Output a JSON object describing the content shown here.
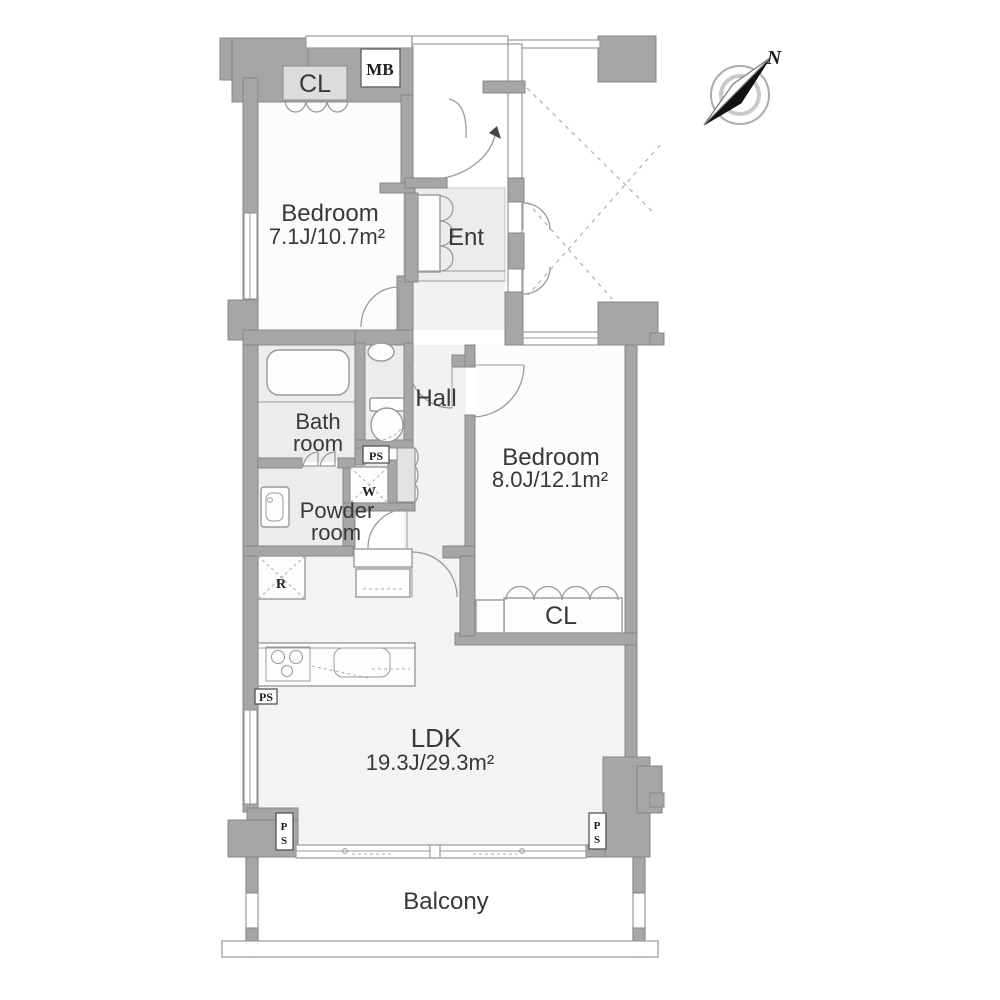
{
  "compass": {
    "north_label": "N"
  },
  "rooms": {
    "bedroom1": {
      "name": "Bedroom",
      "size": "7.1J/10.7m²"
    },
    "bedroom2": {
      "name": "Bedroom",
      "size": "8.0J/12.1m²"
    },
    "ldk": {
      "name": "LDK",
      "size": "19.3J/29.3m²"
    },
    "entrance": {
      "name": "Ent"
    },
    "hall": {
      "name": "Hall"
    },
    "bathroom": {
      "line1": "Bath",
      "line2": "room"
    },
    "powder_room": {
      "line1": "Powder",
      "line2": "room"
    },
    "balcony": {
      "name": "Balcony"
    },
    "closet1": {
      "name": "CL"
    },
    "closet2": {
      "name": "CL"
    }
  },
  "labels": {
    "meter_box": "MB",
    "pipe_shaft": "PS",
    "pipe_shaft_p": "P",
    "pipe_shaft_s": "S",
    "washer": "W",
    "refrigerator": "R"
  },
  "colors": {
    "wall": "#a6a6a6",
    "wet_area_floor": "#ececec",
    "ldk_floor": "#f3f3f3",
    "bedroom_floor": "#fcfcfc",
    "line": "#9a9a9a",
    "text": "#383838"
  }
}
